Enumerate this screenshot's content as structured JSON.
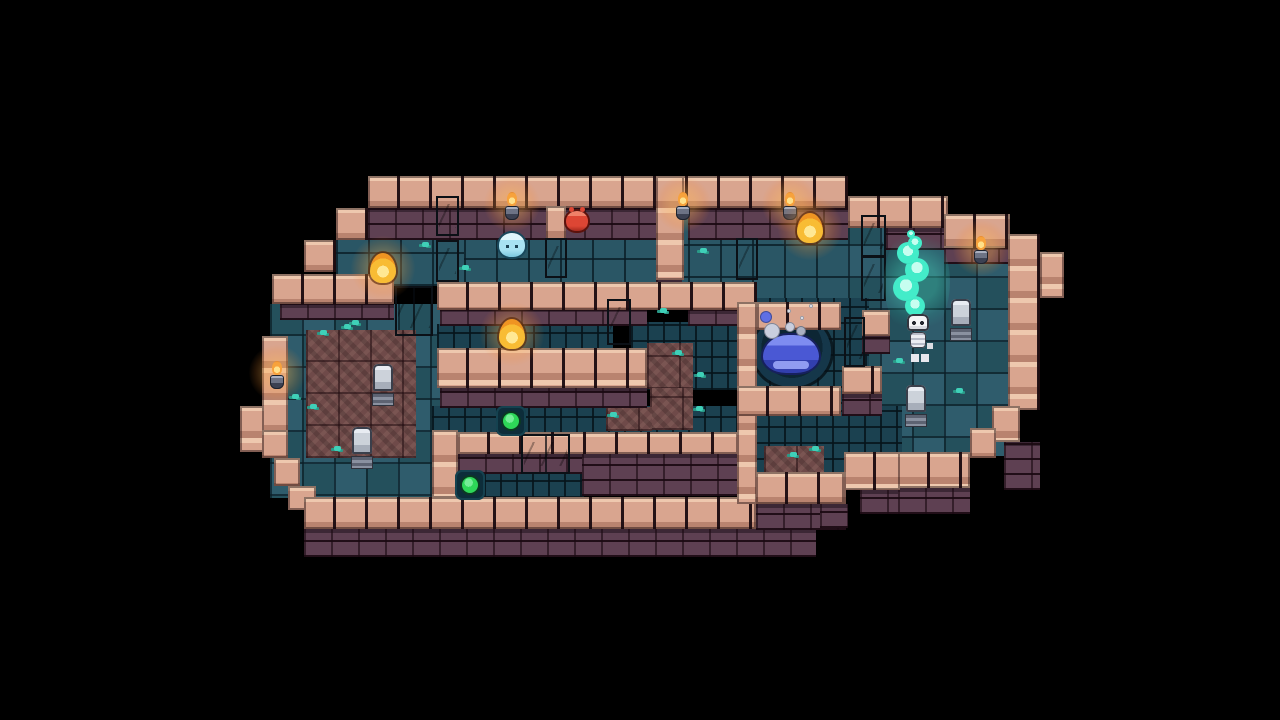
{
  "scene": {
    "type": "pixel-art dungeon room, top-down puzzle level on black backdrop",
    "tile_size": 32,
    "background": "#000000"
  },
  "palette": {
    "background": "#000000",
    "wall_cap": "#d9a58f",
    "wall_cap_highlight": "#eec8ae",
    "wall_face": "#5e4052",
    "floor": "#2a5665",
    "floor_dark": "#1b4150",
    "floor_checker_alt": "#2f5c6c",
    "rubble": "#6f4a49",
    "moss": "#3fd0b8",
    "torch_flame": "#f7a23c",
    "flame_core": "#ffe08a",
    "pool_slime": "#4a58d4",
    "slime_lightblue": "#a8e2f2",
    "slime_red": "#dd4634",
    "button_green": "#2ed858",
    "gravestone": "#ccd2da",
    "player_bone": "#ececf1",
    "soul_flame": "#43ecc9",
    "gates": {
      "blue": {
        "cap": "#9bd4f4",
        "panel": "#3e8fd6"
      },
      "yellow": {
        "cap": "#c9a21e",
        "panel": "#f6d33c"
      },
      "red": {
        "cap": "#f06b4a",
        "panel": "#da3425"
      },
      "orange": {
        "cap": "#f08048",
        "panel": "#e04a26"
      },
      "green": {
        "cap": "#2ed164",
        "panel": "#1fae9e"
      }
    }
  },
  "map": {
    "floors": [
      {
        "t": "f",
        "x": 336,
        "y": 230,
        "w": 130,
        "h": 56
      },
      {
        "t": "f",
        "x": 464,
        "y": 208,
        "w": 192,
        "h": 84
      },
      {
        "t": "f",
        "x": 656,
        "y": 208,
        "w": 192,
        "h": 102
      },
      {
        "t": "k",
        "x": 848,
        "y": 214,
        "w": 160,
        "h": 242
      },
      {
        "t": "k",
        "x": 270,
        "y": 304,
        "w": 178,
        "h": 194
      },
      {
        "t": "d",
        "x": 437,
        "y": 324,
        "w": 176,
        "h": 26
      },
      {
        "t": "d",
        "x": 631,
        "y": 322,
        "w": 106,
        "h": 68
      },
      {
        "t": "d",
        "x": 432,
        "y": 406,
        "w": 306,
        "h": 28
      },
      {
        "t": "d",
        "x": 452,
        "y": 472,
        "w": 132,
        "h": 26
      },
      {
        "t": "d",
        "x": 737,
        "y": 298,
        "w": 132,
        "h": 122
      },
      {
        "t": "d",
        "x": 752,
        "y": 406,
        "w": 150,
        "h": 70
      }
    ],
    "rubble": [
      {
        "x": 306,
        "y": 330,
        "w": 110,
        "h": 128
      },
      {
        "x": 647,
        "y": 343,
        "w": 46,
        "h": 46
      },
      {
        "x": 650,
        "y": 388,
        "w": 43,
        "h": 42
      },
      {
        "x": 606,
        "y": 407,
        "w": 46,
        "h": 24
      },
      {
        "x": 764,
        "y": 446,
        "w": 60,
        "h": 28
      }
    ],
    "faces": [
      {
        "x": 368,
        "y": 208,
        "w": 288,
        "h": 32
      },
      {
        "x": 688,
        "y": 208,
        "w": 160,
        "h": 32
      },
      {
        "x": 886,
        "y": 228,
        "w": 62,
        "h": 22
      },
      {
        "x": 944,
        "y": 246,
        "w": 66,
        "h": 18
      },
      {
        "x": 280,
        "y": 304,
        "w": 114,
        "h": 16
      },
      {
        "x": 440,
        "y": 308,
        "w": 207,
        "h": 18
      },
      {
        "x": 688,
        "y": 310,
        "w": 49,
        "h": 16
      },
      {
        "x": 440,
        "y": 388,
        "w": 207,
        "h": 20
      },
      {
        "x": 458,
        "y": 454,
        "w": 126,
        "h": 20
      },
      {
        "x": 582,
        "y": 454,
        "w": 158,
        "h": 42
      },
      {
        "x": 304,
        "y": 529,
        "w": 512,
        "h": 28
      },
      {
        "x": 756,
        "y": 504,
        "w": 90,
        "h": 26
      },
      {
        "x": 820,
        "y": 504,
        "w": 28,
        "h": 24
      },
      {
        "x": 860,
        "y": 490,
        "w": 40,
        "h": 24
      },
      {
        "x": 898,
        "y": 488,
        "w": 72,
        "h": 26
      },
      {
        "x": 1004,
        "y": 442,
        "w": 36,
        "h": 48
      },
      {
        "x": 656,
        "y": 278,
        "w": 26,
        "h": 28
      },
      {
        "x": 842,
        "y": 394,
        "w": 40,
        "h": 22
      },
      {
        "x": 862,
        "y": 336,
        "w": 28,
        "h": 18
      }
    ],
    "caps": [
      {
        "x": 368,
        "y": 176,
        "w": 480,
        "h": 32
      },
      {
        "x": 336,
        "y": 208,
        "w": 32,
        "h": 32
      },
      {
        "x": 304,
        "y": 240,
        "w": 32,
        "h": 32
      },
      {
        "x": 272,
        "y": 274,
        "w": 122,
        "h": 30
      },
      {
        "x": 262,
        "y": 336,
        "w": 26,
        "h": 96
      },
      {
        "x": 240,
        "y": 406,
        "w": 24,
        "h": 46
      },
      {
        "x": 262,
        "y": 430,
        "w": 26,
        "h": 28
      },
      {
        "x": 274,
        "y": 458,
        "w": 26,
        "h": 28
      },
      {
        "x": 288,
        "y": 486,
        "w": 28,
        "h": 24
      },
      {
        "x": 304,
        "y": 497,
        "w": 452,
        "h": 32
      },
      {
        "x": 437,
        "y": 282,
        "w": 320,
        "h": 28
      },
      {
        "x": 437,
        "y": 348,
        "w": 210,
        "h": 40
      },
      {
        "x": 458,
        "y": 432,
        "w": 280,
        "h": 22
      },
      {
        "x": 432,
        "y": 430,
        "w": 26,
        "h": 68
      },
      {
        "x": 656,
        "y": 176,
        "w": 28,
        "h": 104
      },
      {
        "x": 737,
        "y": 302,
        "w": 20,
        "h": 202
      },
      {
        "x": 757,
        "y": 302,
        "w": 84,
        "h": 28
      },
      {
        "x": 737,
        "y": 386,
        "w": 104,
        "h": 30
      },
      {
        "x": 842,
        "y": 366,
        "w": 40,
        "h": 28
      },
      {
        "x": 862,
        "y": 310,
        "w": 28,
        "h": 26
      },
      {
        "x": 848,
        "y": 196,
        "w": 100,
        "h": 32
      },
      {
        "x": 944,
        "y": 214,
        "w": 66,
        "h": 34
      },
      {
        "x": 1008,
        "y": 234,
        "w": 32,
        "h": 176
      },
      {
        "x": 1040,
        "y": 252,
        "w": 24,
        "h": 46
      },
      {
        "x": 992,
        "y": 406,
        "w": 28,
        "h": 36
      },
      {
        "x": 970,
        "y": 428,
        "w": 26,
        "h": 30
      },
      {
        "x": 898,
        "y": 452,
        "w": 72,
        "h": 36
      },
      {
        "x": 844,
        "y": 452,
        "w": 56,
        "h": 38
      },
      {
        "x": 820,
        "y": 472,
        "w": 26,
        "h": 32
      },
      {
        "x": 756,
        "y": 472,
        "w": 88,
        "h": 32
      }
    ],
    "gates": [
      {
        "color": "blue",
        "x": 436,
        "y": 196,
        "w": 23,
        "h": 40,
        "double": false
      },
      {
        "color": "yellow",
        "x": 436,
        "y": 240,
        "w": 23,
        "h": 42,
        "double": false
      },
      {
        "color": "blue",
        "x": 545,
        "y": 238,
        "w": 22,
        "h": 40,
        "double": false
      },
      {
        "color": "red",
        "x": 395,
        "y": 286,
        "w": 38,
        "h": 50,
        "double": true
      },
      {
        "color": "orange",
        "x": 607,
        "y": 299,
        "w": 24,
        "h": 46,
        "double": false
      },
      {
        "color": "green",
        "x": 736,
        "y": 238,
        "w": 22,
        "h": 42,
        "double": false
      },
      {
        "color": "green",
        "x": 844,
        "y": 317,
        "w": 21,
        "h": 50,
        "double": false
      },
      {
        "color": "green",
        "x": 861,
        "y": 215,
        "w": 25,
        "h": 42,
        "double": false
      },
      {
        "color": "yellow",
        "x": 861,
        "y": 256,
        "w": 25,
        "h": 45,
        "double": false
      },
      {
        "color": "blue",
        "x": 521,
        "y": 434,
        "w": 49,
        "h": 40,
        "double": true
      }
    ],
    "stub_walls": [
      {
        "x": 546,
        "y": 206,
        "w": 20,
        "h": 34
      }
    ],
    "torches": [
      {
        "x": 503,
        "y": 192
      },
      {
        "x": 674,
        "y": 192
      },
      {
        "x": 781,
        "y": 192
      },
      {
        "x": 972,
        "y": 236
      },
      {
        "x": 268,
        "y": 361
      }
    ],
    "flame_orbs": [
      {
        "x": 370,
        "y": 253
      },
      {
        "x": 499,
        "y": 319
      },
      {
        "x": 797,
        "y": 213
      }
    ],
    "slimes": [
      {
        "kind": "lightblue",
        "x": 499,
        "y": 233
      },
      {
        "kind": "red",
        "x": 566,
        "y": 211
      }
    ],
    "pool": {
      "pit": {
        "x": 753,
        "y": 315,
        "w": 78,
        "h": 72
      },
      "slime": {
        "x": 763,
        "y": 335,
        "w": 56,
        "h": 38
      },
      "bubbles": [
        {
          "x": 772,
          "y": 331,
          "r": 8,
          "c": "#c9cede"
        },
        {
          "x": 766,
          "y": 317,
          "r": 6,
          "c": "#5f6fe4"
        },
        {
          "x": 790,
          "y": 327,
          "r": 5,
          "c": "#c9cede"
        },
        {
          "x": 801,
          "y": 331,
          "r": 5,
          "c": "#aab1c2"
        },
        {
          "x": 789,
          "y": 311,
          "r": 2,
          "c": "#eef1f8"
        },
        {
          "x": 802,
          "y": 318,
          "r": 2,
          "c": "#eef1f8"
        },
        {
          "x": 811,
          "y": 306,
          "r": 2,
          "c": "#eef1f8"
        }
      ]
    },
    "buttons": [
      {
        "x": 496,
        "y": 406
      },
      {
        "x": 455,
        "y": 470
      }
    ],
    "gravestones": [
      {
        "x": 373,
        "y": 364
      },
      {
        "x": 352,
        "y": 427
      },
      {
        "x": 951,
        "y": 299
      },
      {
        "x": 906,
        "y": 385
      }
    ],
    "moss": [
      {
        "x": 320,
        "y": 330
      },
      {
        "x": 344,
        "y": 324
      },
      {
        "x": 292,
        "y": 394
      },
      {
        "x": 310,
        "y": 404
      },
      {
        "x": 334,
        "y": 446
      },
      {
        "x": 352,
        "y": 320
      },
      {
        "x": 422,
        "y": 242
      },
      {
        "x": 462,
        "y": 265
      },
      {
        "x": 610,
        "y": 412
      },
      {
        "x": 675,
        "y": 350
      },
      {
        "x": 697,
        "y": 372
      },
      {
        "x": 696,
        "y": 406
      },
      {
        "x": 790,
        "y": 452
      },
      {
        "x": 812,
        "y": 446
      },
      {
        "x": 896,
        "y": 358
      },
      {
        "x": 956,
        "y": 388
      },
      {
        "x": 660,
        "y": 308
      },
      {
        "x": 700,
        "y": 248
      }
    ],
    "player": {
      "x": 903,
      "y": 314,
      "soul_trail": [
        {
          "x": 915,
          "y": 306,
          "r": 10
        },
        {
          "x": 906,
          "y": 288,
          "r": 13
        },
        {
          "x": 917,
          "y": 270,
          "r": 12
        },
        {
          "x": 908,
          "y": 253,
          "r": 11
        },
        {
          "x": 915,
          "y": 243,
          "r": 7
        },
        {
          "x": 911,
          "y": 234,
          "r": 4
        }
      ],
      "soul_glow": {
        "x": 884,
        "y": 226,
        "w": 66,
        "h": 112
      }
    }
  }
}
